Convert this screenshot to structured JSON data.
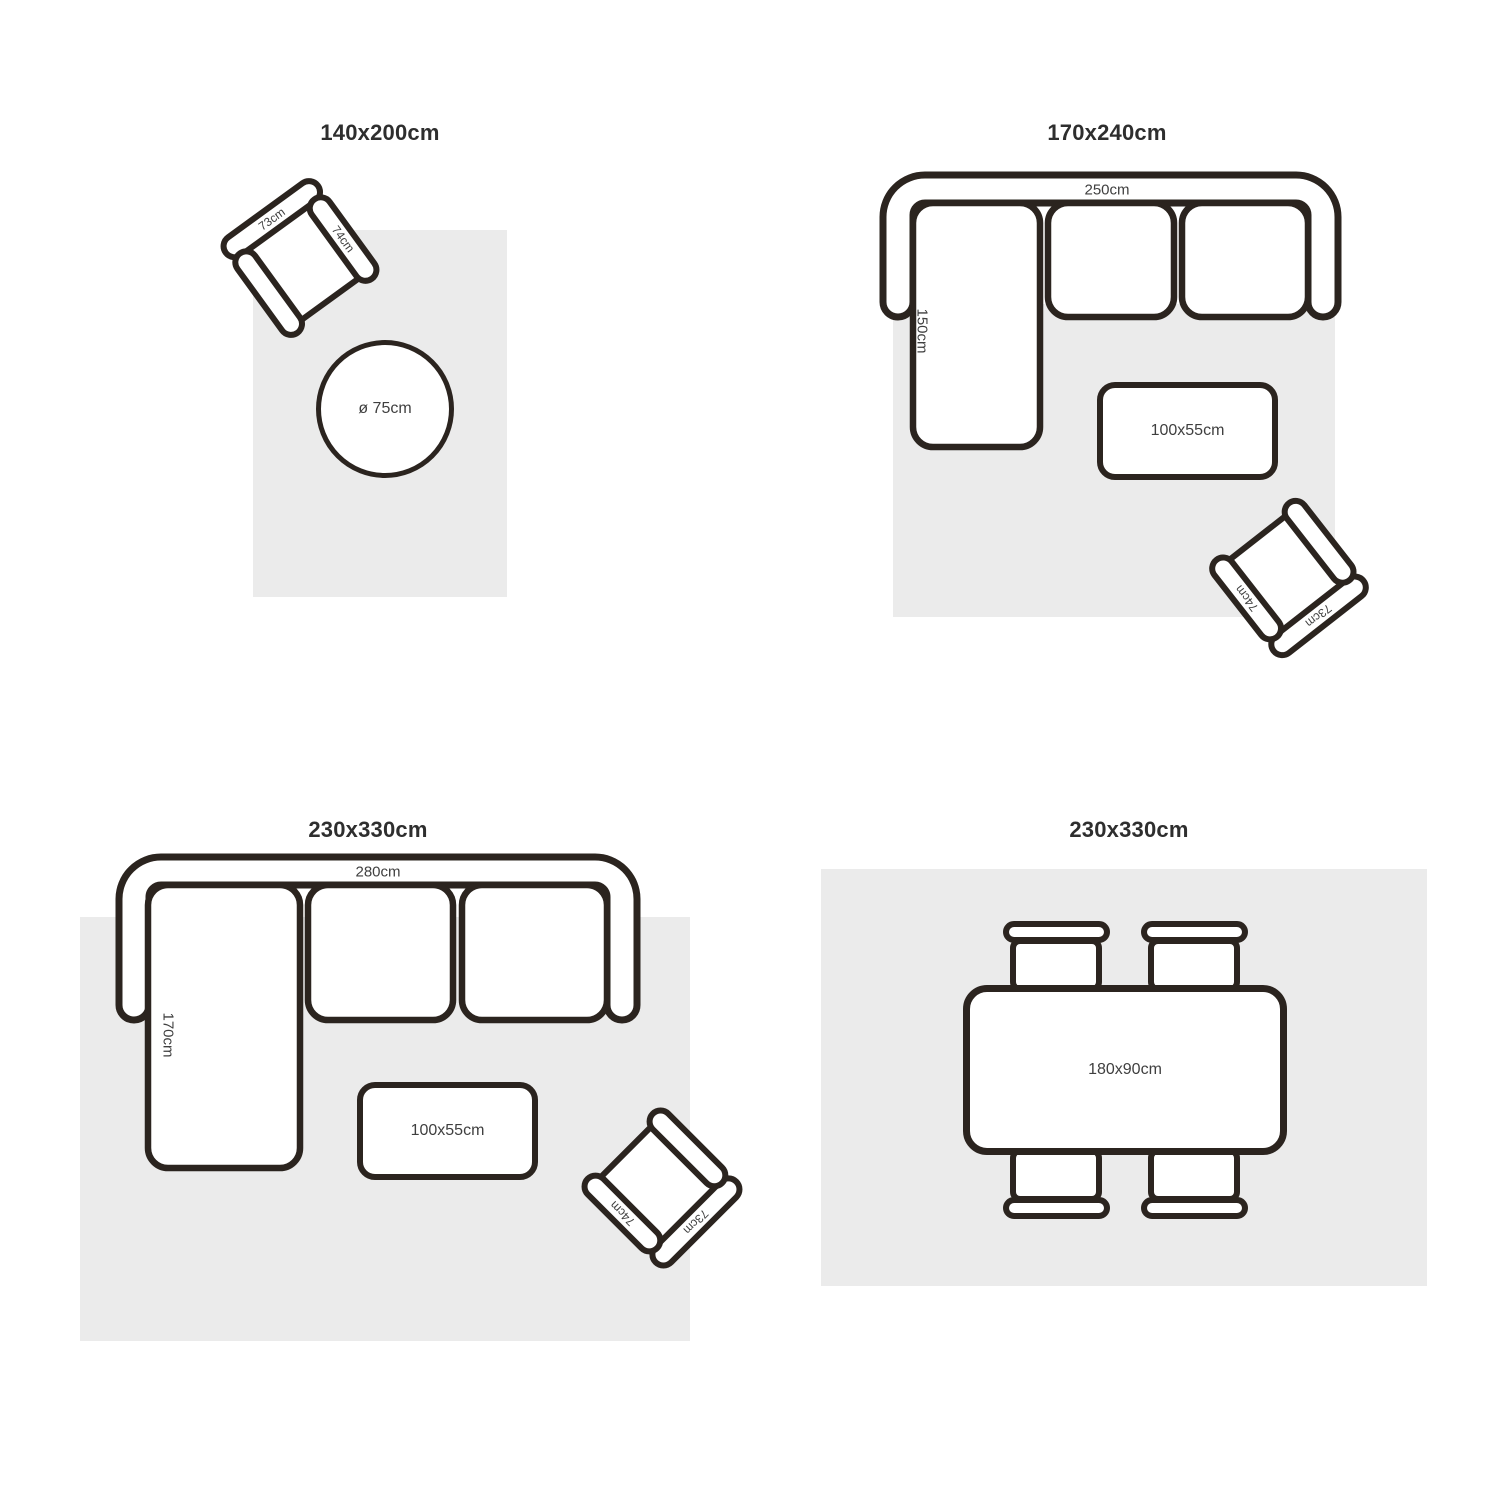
{
  "colors": {
    "outline": "#2b241f",
    "rug": "#ebebeb",
    "title_text": "#2e2e2e",
    "label_text": "#3f3f3f"
  },
  "panels": [
    {
      "id": "rug-140x200",
      "title": "140x200cm",
      "armchair": {
        "back_label": "73cm",
        "arm_label": "74cm"
      },
      "round_table": {
        "label": "ø 75cm"
      }
    },
    {
      "id": "rug-170x240",
      "title": "170x240cm",
      "sofa": {
        "width_label": "250cm",
        "depth_label": "150cm"
      },
      "coffee_table": {
        "label": "100x55cm"
      },
      "armchair": {
        "back_label": "73cm",
        "arm_label": "74cm"
      }
    },
    {
      "id": "rug-230x330-sofa",
      "title": "230x330cm",
      "sofa": {
        "width_label": "280cm",
        "depth_label": "170cm"
      },
      "coffee_table": {
        "label": "100x55cm"
      },
      "armchair": {
        "back_label": "73cm",
        "arm_label": "74cm"
      }
    },
    {
      "id": "rug-230x330-dining",
      "title": "230x330cm",
      "dining_table": {
        "label": "180x90cm"
      }
    }
  ]
}
